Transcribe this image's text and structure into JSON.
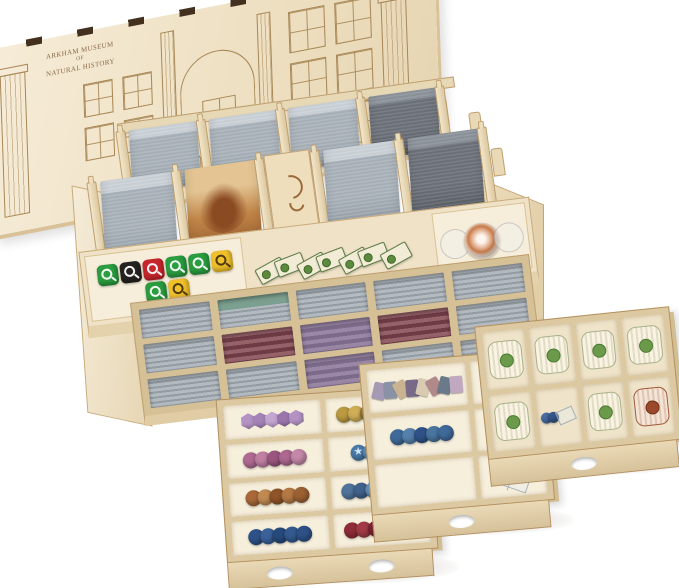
{
  "meta": {
    "subject": "laser-cut plywood board game organizer, lid open, with card stacks, dice, token trays",
    "background_color": "#ffffff"
  },
  "palette": {
    "wood": "#ecdfc2",
    "wood_edge": "#c9a876",
    "engraving": "#8a6a46",
    "card_back_grey": "#a0a9b1",
    "notch_dark": "#43301f"
  },
  "lid": {
    "engraving": {
      "line1": "ARKHAM MUSEUM",
      "line2": "OF",
      "line3": "NATURAL HISTORY"
    },
    "artwork": "museum facade with columns, arched entrance, windows and two cat statues"
  },
  "box": {
    "back_stacks": [
      "grey",
      "grey",
      "grey",
      "dark"
    ],
    "mid_stacks": [
      "grey",
      "art",
      "kraken",
      "grey",
      "dark"
    ],
    "dice": [
      {
        "bg": "#2a9d3f",
        "cls": "die"
      },
      {
        "bg": "#26221f",
        "cls": "die"
      },
      {
        "bg": "#c9252c",
        "cls": "die"
      },
      {
        "bg": "#2a9d3f",
        "cls": "die"
      },
      {
        "bg": "#2a9d3f",
        "cls": "die"
      },
      {
        "bg": "#f0c12a",
        "cls": "die dsym"
      },
      {
        "bg": "#2a9d3f",
        "cls": "die"
      },
      {
        "bg": "#f0c12a",
        "cls": "die dsym"
      }
    ],
    "mini_cards": [
      {
        "cls": "mcard"
      },
      {
        "cls": "mcard"
      },
      {
        "cls": "mcard"
      },
      {
        "cls": "mcard"
      },
      {
        "cls": "mcard"
      },
      {
        "cls": "mcard"
      },
      {
        "cls": "mcard"
      }
    ],
    "swirl_tokens": [
      {
        "cls": "clear"
      },
      {
        "cls": "swirl"
      },
      {
        "cls": "clear"
      }
    ],
    "front_cells": [
      [
        "grey",
        "green",
        "grey",
        "grey",
        "grey"
      ],
      [
        "grey",
        "maroon",
        "purple",
        "maroon",
        "grey"
      ],
      [
        "grey",
        "grey",
        "purple",
        "grey",
        "grey"
      ]
    ]
  },
  "trays": {
    "left": {
      "compartments": {
        "r1c1": [
          {
            "bg": "#b493c4",
            "cls": "hex"
          },
          {
            "bg": "#a583b8",
            "cls": "hex"
          },
          {
            "bg": "#c3a6d2",
            "cls": "hex"
          },
          {
            "bg": "#9a76ad",
            "cls": "hex"
          },
          {
            "bg": "#b493c4",
            "cls": "hex"
          }
        ],
        "r1c2": [
          {
            "bg": "#bb9a41",
            "cls": "pat"
          },
          {
            "bg": "#cfae56",
            "cls": "pat"
          },
          {
            "bg": "#8f7530",
            "cls": "pat"
          },
          {
            "bg": "#c4a34b",
            "cls": "pat"
          },
          {
            "bg": "#a88a38",
            "cls": "pat"
          },
          {
            "bg": "#d4b765",
            "cls": "pat"
          }
        ],
        "r2c1": [
          {
            "bg": "#b06a92",
            "cls": "pat"
          },
          {
            "bg": "#c07fa3",
            "cls": "pat"
          },
          {
            "bg": "#9a567f",
            "cls": "pat"
          },
          {
            "bg": "#ad6790",
            "cls": "pat"
          },
          {
            "bg": "#c488a8",
            "cls": "pat"
          }
        ],
        "r2c2": [
          {
            "bg": "#4a7aa8",
            "cls": "star"
          },
          {
            "bg": "#5788b5",
            "cls": "star"
          },
          {
            "bg": "#3f6c99",
            "cls": "star"
          },
          {
            "bg": "#4a7aa8",
            "cls": "star"
          }
        ],
        "r3c1": [
          {
            "bg": "#a8683a",
            "cls": "pat"
          },
          {
            "bg": "#c08a52",
            "cls": "pat"
          },
          {
            "bg": "#8f5428",
            "cls": "pat"
          },
          {
            "bg": "#b37844",
            "cls": "pat"
          },
          {
            "bg": "#9c6132",
            "cls": "pat"
          }
        ],
        "r3c2": [
          {
            "bg": "#50749c",
            "cls": "pat"
          },
          {
            "bg": "#40618a",
            "cls": "pat"
          },
          {
            "bg": "#628cb3",
            "cls": "pat"
          },
          {
            "bg": "#48698f",
            "cls": "pat"
          },
          {
            "bg": "#577ca3",
            "cls": "pat"
          },
          {
            "bg": "#3d5d85",
            "cls": "pat"
          }
        ],
        "r4c1": [
          {
            "bg": "#2e5288",
            "cls": "oct"
          },
          {
            "bg": "#3a619a",
            "cls": "oct"
          },
          {
            "bg": "#274a7c",
            "cls": "oct"
          },
          {
            "bg": "#335a90",
            "cls": "oct"
          },
          {
            "bg": "#2e5288",
            "cls": "oct"
          }
        ],
        "r4c2": [
          {
            "bg": "#8f2c38",
            "cls": "pat"
          },
          {
            "bg": "#a23a46",
            "cls": "pat"
          },
          {
            "bg": "#7a222e",
            "cls": "pat"
          },
          {
            "bg": "#96313d",
            "cls": "pat"
          },
          {
            "bg": "#872834",
            "cls": "pat"
          },
          {
            "bg": "#a23a46",
            "cls": "pat"
          }
        ]
      }
    },
    "middle": {
      "standees": [
        {
          "bg": "#a59ab5",
          "cls": "standee"
        },
        {
          "bg": "#8a93a5",
          "cls": "standee"
        },
        {
          "bg": "#c9b391",
          "cls": "standee"
        },
        {
          "bg": "#7a6a8a",
          "cls": "standee"
        },
        {
          "bg": "#d9cbb1",
          "cls": "standee"
        },
        {
          "bg": "#b08a8a",
          "cls": "standee"
        },
        {
          "bg": "#6a7a8a",
          "cls": "standee"
        },
        {
          "bg": "#c0a8c0",
          "cls": "standee"
        }
      ],
      "blue_tokens": [
        {
          "bg": "#3f6a9a",
          "cls": "pat"
        },
        {
          "bg": "#5580ab",
          "cls": "pat"
        },
        {
          "bg": "#2e5288",
          "cls": "pat"
        },
        {
          "bg": "#49759f",
          "cls": "pat"
        },
        {
          "bg": "#3f6a9a",
          "cls": "pat"
        }
      ],
      "small_dice": [
        {
          "bg": "#b03038",
          "cls": "die2"
        },
        {
          "bg": "#2e8f8a",
          "cls": "die2"
        }
      ]
    },
    "right": {
      "slots": [
        "green",
        "green",
        "green",
        "green",
        "green",
        "mixed",
        "green",
        "red"
      ]
    }
  }
}
